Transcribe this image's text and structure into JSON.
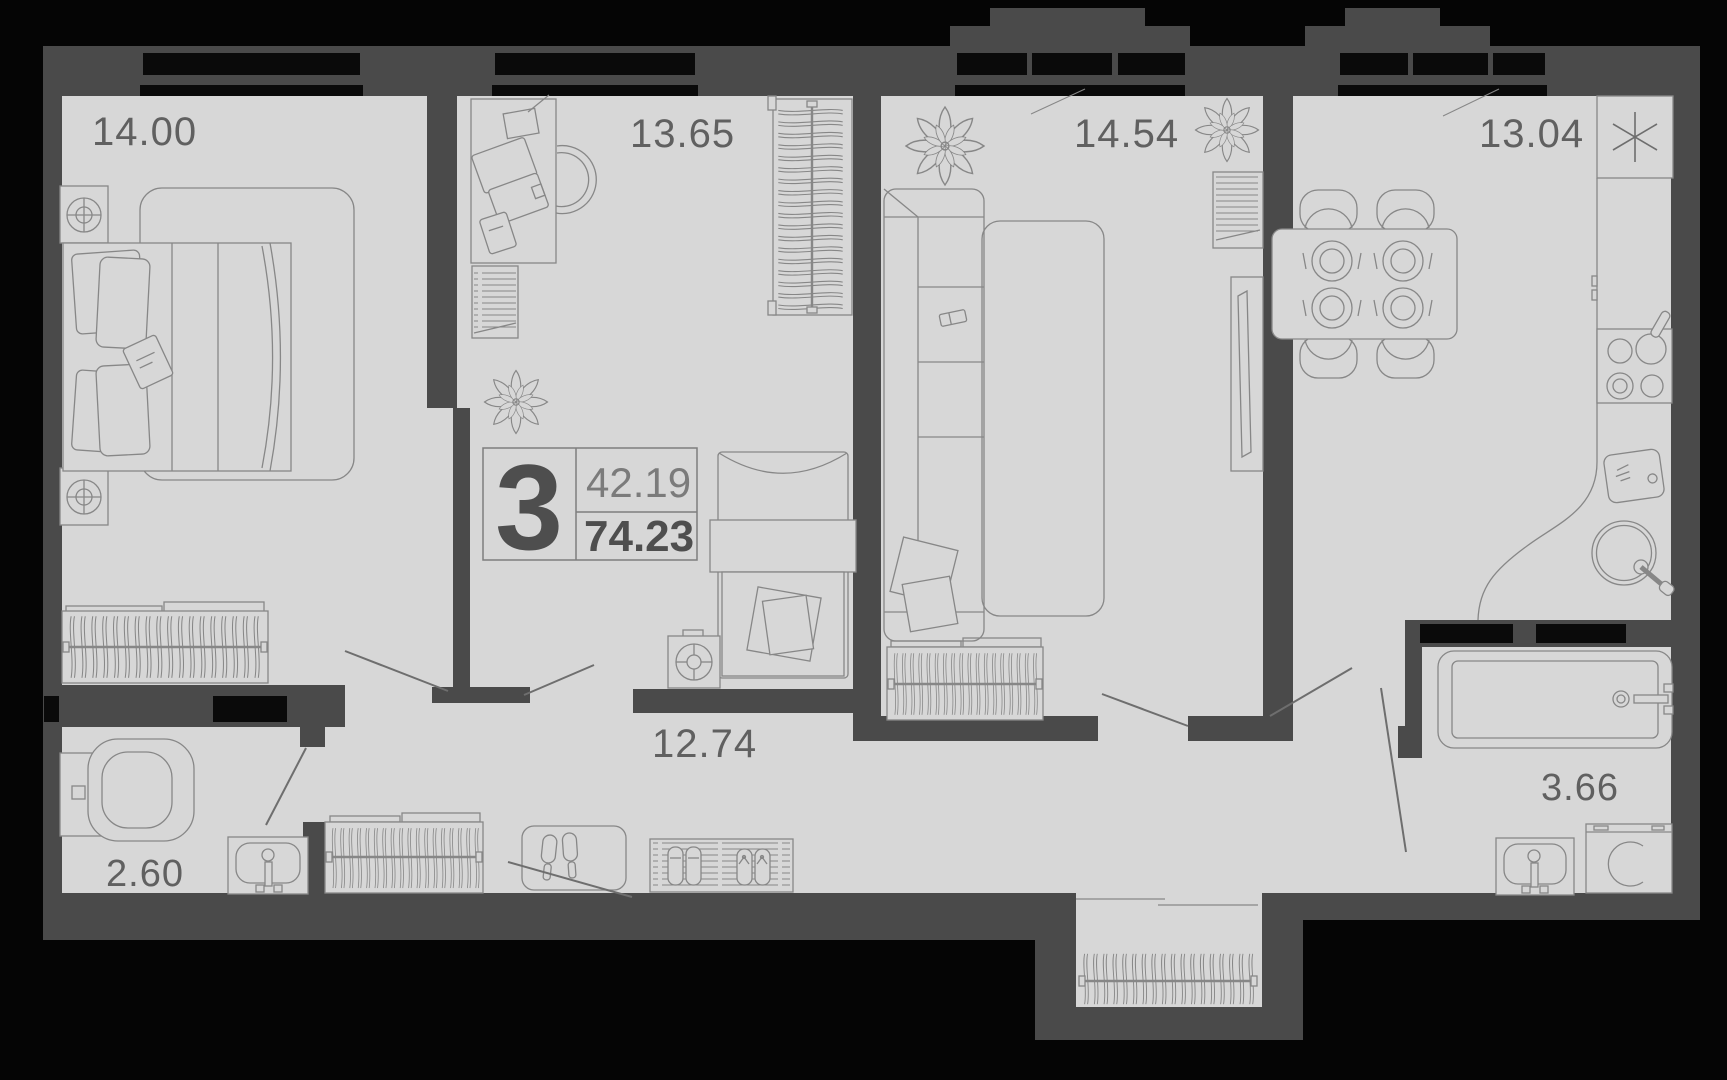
{
  "plan": {
    "title": "3-room apartment floor plan",
    "unit": {
      "rooms_count": "3",
      "living_area": "42.19",
      "total_area": "74.23"
    },
    "rooms": [
      {
        "name": "bedroom",
        "area": "14.00"
      },
      {
        "name": "study-bedroom",
        "area": "13.65"
      },
      {
        "name": "living-room",
        "area": "14.54"
      },
      {
        "name": "kitchen",
        "area": "13.04"
      },
      {
        "name": "hallway",
        "area": "12.74"
      },
      {
        "name": "toilet",
        "area": "2.60"
      },
      {
        "name": "bathroom",
        "area": "3.66"
      }
    ],
    "icons": [
      "ventilation-asterisk-icon"
    ],
    "colors": {
      "background": "#050505",
      "wall": "#4a4a4a",
      "floor": "#d7d7d7",
      "furniture_line": "#878787",
      "label_text": "#606060",
      "area_total_text": "#4e4e4e",
      "area_living_text": "#7b7b7b",
      "window_glass": "#0a0a0a"
    }
  }
}
